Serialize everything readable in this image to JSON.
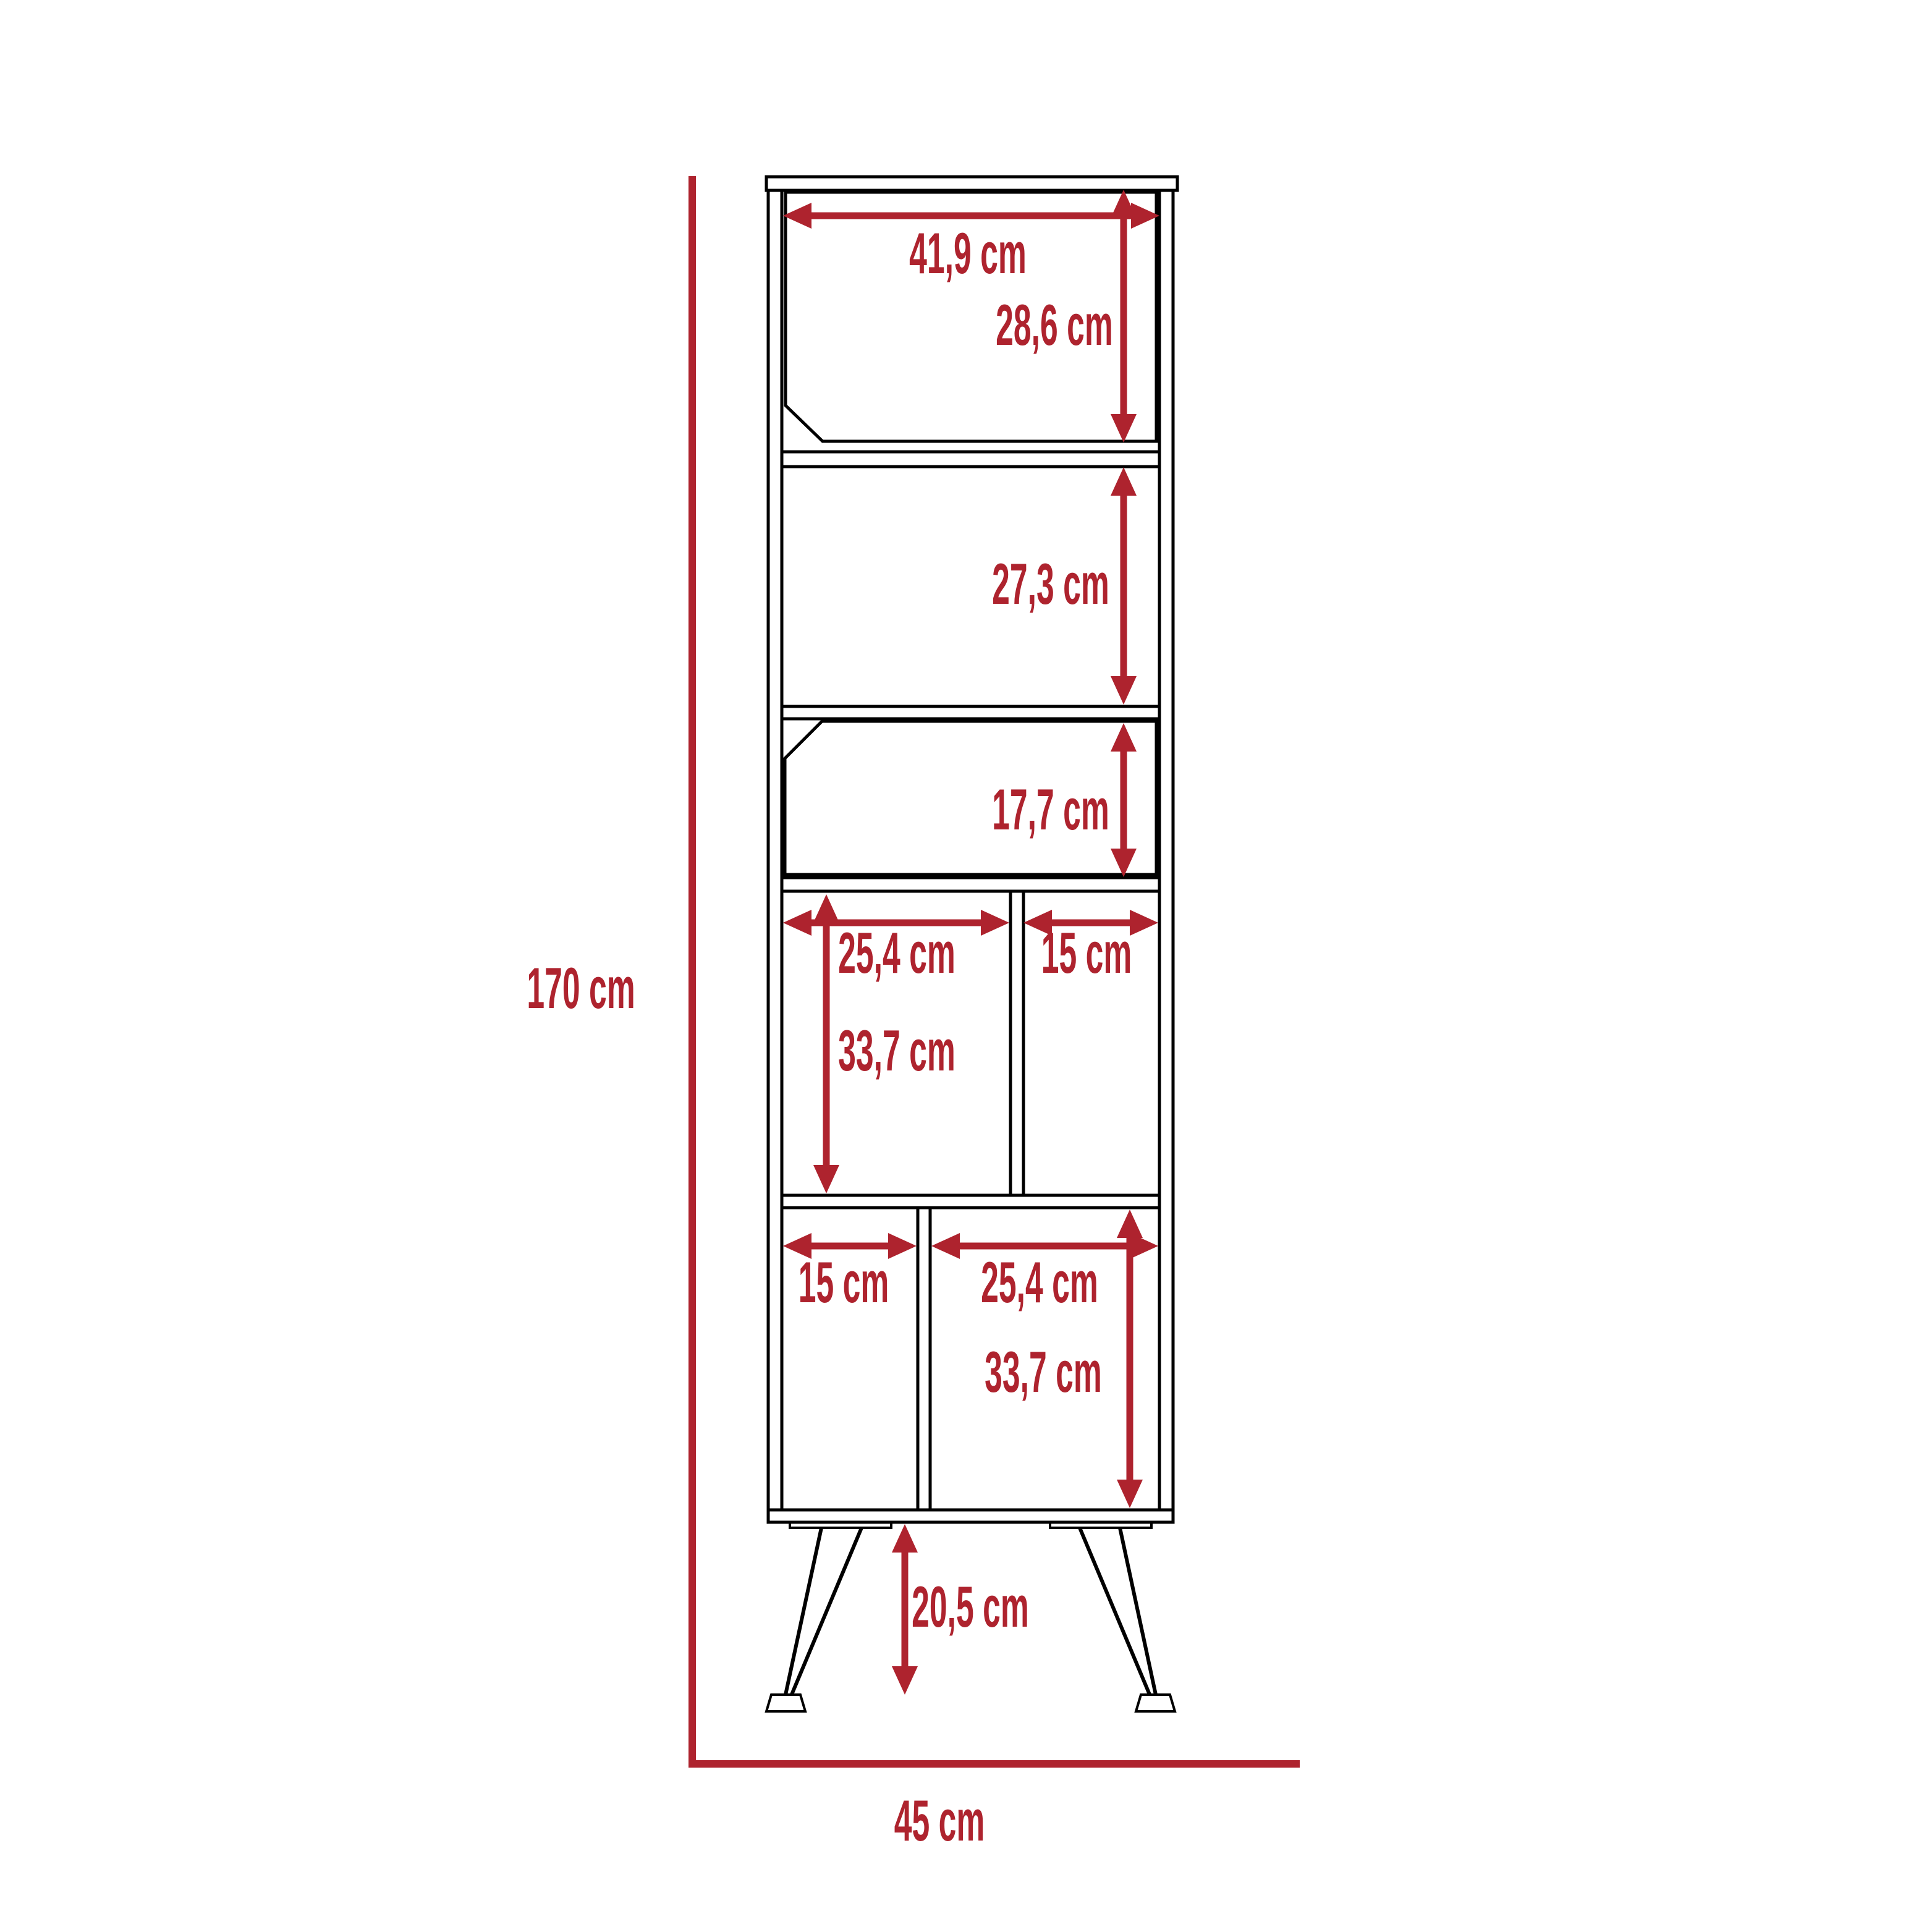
{
  "diagram": {
    "type": "furniture-dimension-diagram",
    "unit": "cm",
    "accent_color": "#AE232E",
    "line_color": "#000000",
    "background_color": "#FFFFFF",
    "overall": {
      "height_label": "170 cm",
      "width_label": "45 cm"
    },
    "sections": {
      "top_door": {
        "width_label": "41,9 cm",
        "height_label": "28,6 cm"
      },
      "open_shelf": {
        "height_label": "27,3 cm"
      },
      "small_door": {
        "height_label": "17,7 cm"
      },
      "upper_cubbies": {
        "left_width_label": "25,4 cm",
        "right_width_label": "15 cm",
        "height_label": "33,7 cm"
      },
      "lower_cubbies": {
        "left_width_label": "15 cm",
        "right_width_label": "25,4 cm",
        "height_label": "33,7 cm"
      },
      "legs": {
        "height_label": "20,5 cm"
      }
    }
  }
}
